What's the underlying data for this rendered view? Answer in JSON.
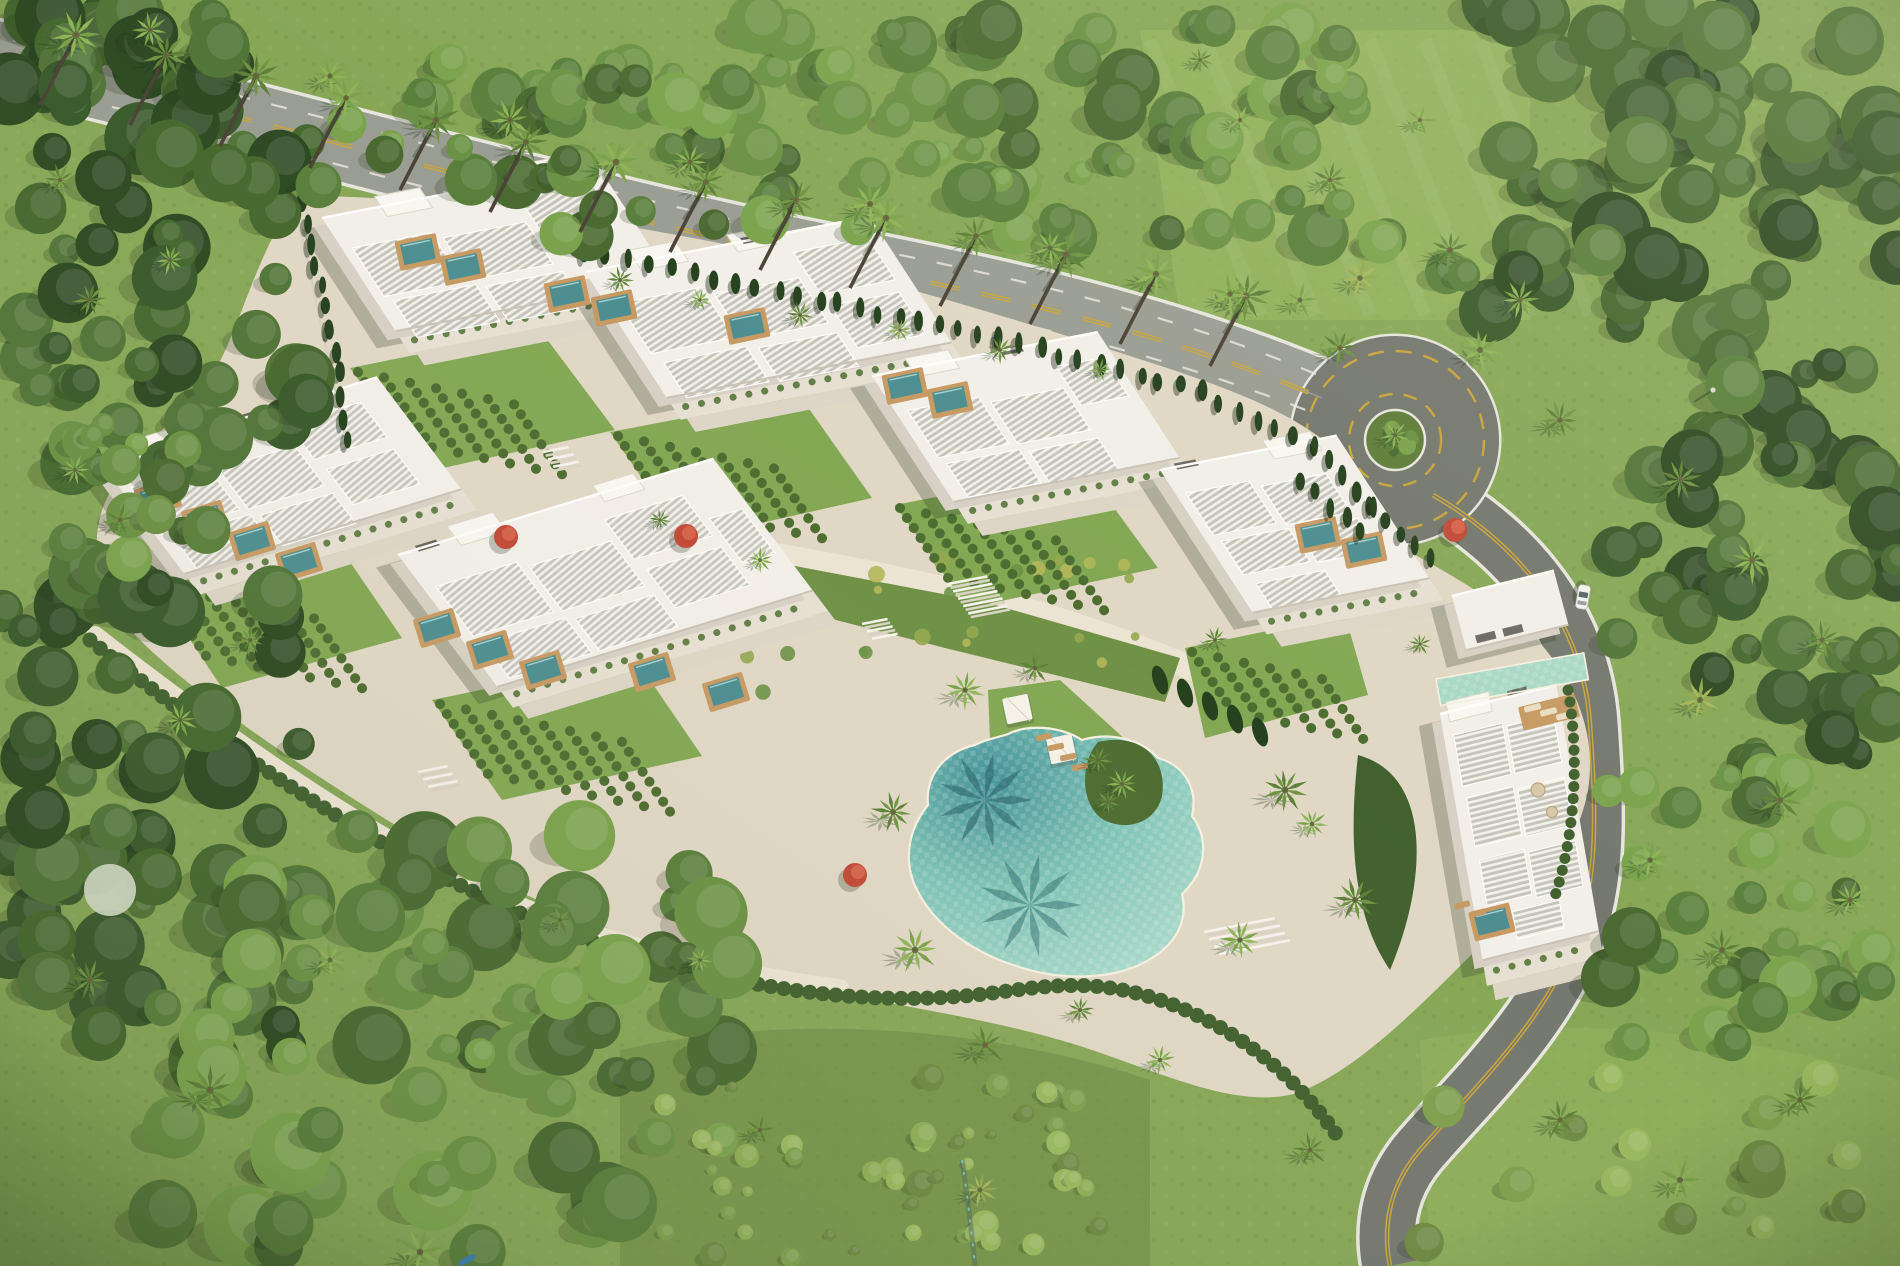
{
  "scene": {
    "title": "Aerial view of a tropical luxury villa complex",
    "description": "Daytime aerial 3D rendering of a gated residential resort: six white modern villa blocks with louvered rooftop pergolas and turquoise plunge pools, terraced hedge gardens, a freeform lagoon pool with cabanas and loungers, a palm-lined avenue, a roundabout and a curving access road, all surrounded by dense tropical forest and meadows.",
    "lighting": "sunny, shadows falling to the lower-left"
  },
  "inventory": {
    "villa_blocks": 6,
    "entrance_pavilion": 1,
    "rooftop_plunge_pools": 19,
    "lagoon_pool": 1,
    "lap_pool": 1,
    "cabanas": 2,
    "loungers": 9,
    "roundabout": 1,
    "roads": 2,
    "cars": 1,
    "canoe": 1,
    "red_flowering_trees": 4
  },
  "colors": {
    "meadow": "#87a757",
    "meadow_dark": "#6f8a44",
    "sand": "#e0d8c5",
    "sand_light": "#ebe4d2",
    "asphalt": "#9a9d92",
    "asphalt_dark": "#75786e",
    "road_edge": "#e6e6dc",
    "road_yellow": "#c9a53c",
    "building_white": "#f2efe8",
    "building_shade": "#d6d1c4",
    "louver_gray": "#c6c4ba",
    "louver_stripe": "#f2f1ea",
    "terrace1": "#e6e0d2",
    "terrace2": "#ddd6c6",
    "pool_base": "#8fcabe",
    "pool_deep": "#47969b",
    "pool_light": "#aedbcc",
    "pool_shadow": "#1f5a60",
    "lap_pool": "#a9d8c6",
    "plunge_pool": "#4d8e91",
    "wood": "#c79a63",
    "lawn": "#83a854",
    "lawn_light": "#9ab963",
    "hedge": "#4e6d31",
    "hedge_dark": "#42612f",
    "cypress": "#26411e",
    "shadow": "#2e3c26",
    "red_flower": "#c14a36",
    "white_flower": "#cfd8c2",
    "car_white": "#f4f4f0",
    "canoe_blue": "#3f7fae",
    "trunk": "#4a4336",
    "forest_dark": [
      "#2e4a22",
      "#3a5a2b",
      "#46682f",
      "#527538"
    ],
    "forest_mid": [
      "#4a6a31",
      "#5a7f3c",
      "#6b9245",
      "#7ba34d"
    ],
    "forest_light": [
      "#6f8a44",
      "#7fa04e",
      "#8fae57",
      "#9ab85f"
    ],
    "palm_green": [
      "#5d8038",
      "#6f9443"
    ],
    "palm_light": [
      "#7aa24a",
      "#8fb457"
    ],
    "palm_yellow": [
      "#93a94f",
      "#a5b75c"
    ]
  }
}
